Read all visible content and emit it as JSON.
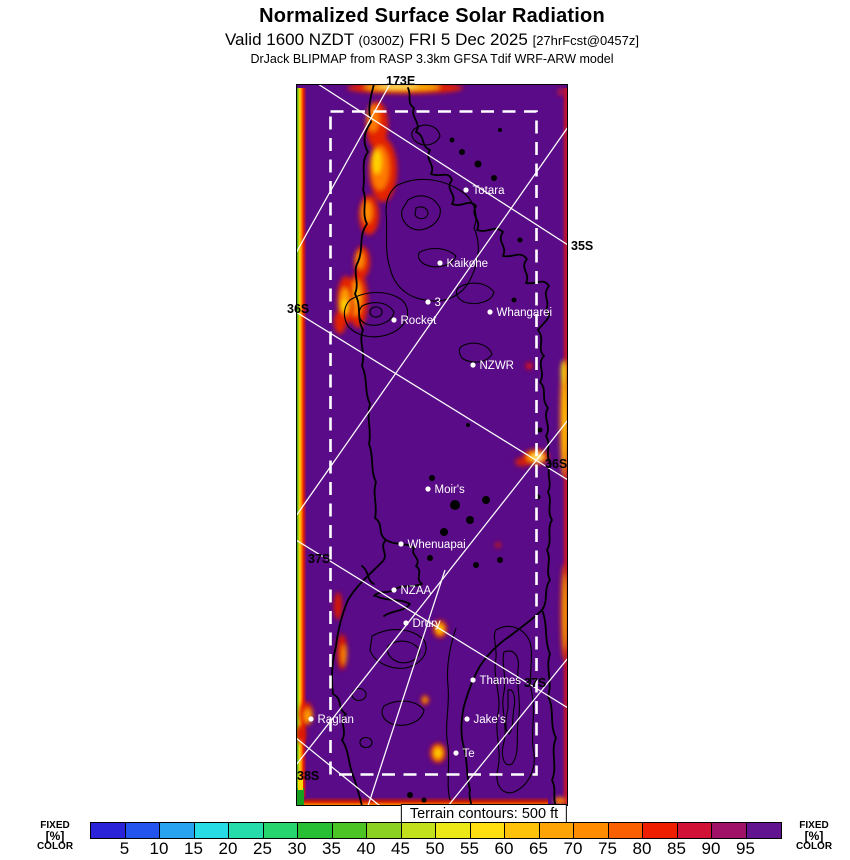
{
  "header": {
    "title": "Normalized Surface Solar Radiation",
    "valid_main_1": "Valid 1600 NZDT ",
    "valid_small_1": "(0300Z)",
    "valid_main_2": " FRI 5 Dec 2025 ",
    "valid_small_2": "[27hrFcst@0457z]",
    "model_line": "DrJack BLIPMAP from RASP 3.3km GFSA Tdif WRF-ARW model"
  },
  "map": {
    "terrain_note": "Terrain contours: 500 ft",
    "background_color": "#5a0b87",
    "stations": [
      {
        "name": "Totara",
        "x": 466,
        "y": 190
      },
      {
        "name": "Kaikohe",
        "x": 440,
        "y": 263
      },
      {
        "name": "3",
        "x": 428,
        "y": 302
      },
      {
        "name": "Rocket",
        "x": 394,
        "y": 320
      },
      {
        "name": "Whangarei",
        "x": 490,
        "y": 312
      },
      {
        "name": "NZWR",
        "x": 473,
        "y": 365
      },
      {
        "name": "Moir's",
        "x": 428,
        "y": 489
      },
      {
        "name": "Whenuapai",
        "x": 401,
        "y": 544
      },
      {
        "name": "NZAA",
        "x": 394,
        "y": 590
      },
      {
        "name": "Drury",
        "x": 406,
        "y": 623
      },
      {
        "name": "Thames",
        "x": 473,
        "y": 680
      },
      {
        "name": "Jake's",
        "x": 467,
        "y": 719
      },
      {
        "name": "Te",
        "x": 456,
        "y": 753
      },
      {
        "name": "Raglan",
        "x": 311,
        "y": 719
      }
    ],
    "grid_labels": [
      {
        "text": "173E",
        "x": 386,
        "y": 85
      },
      {
        "text": "35S",
        "x": 571,
        "y": 250
      },
      {
        "text": "36S",
        "x": 287,
        "y": 313
      },
      {
        "text": "36S",
        "x": 545,
        "y": 468
      },
      {
        "text": "37S",
        "x": 308,
        "y": 563
      },
      {
        "text": "37S",
        "x": 524,
        "y": 687
      },
      {
        "text": "38S",
        "x": 297,
        "y": 780
      }
    ]
  },
  "colorbar": {
    "units_label_lines": [
      "FIXED",
      "[%]",
      "COLOR"
    ],
    "unit": "%",
    "ticks": [
      "5",
      "10",
      "15",
      "20",
      "25",
      "30",
      "35",
      "40",
      "45",
      "50",
      "55",
      "60",
      "65",
      "70",
      "75",
      "80",
      "85",
      "90",
      "95"
    ],
    "segment_colors": [
      "#2a23d8",
      "#2355ee",
      "#27a3f2",
      "#27dce4",
      "#26dcab",
      "#26d56d",
      "#28bf35",
      "#4cc524",
      "#8ad121",
      "#c3e01d",
      "#ece818",
      "#ffdf10",
      "#ffc20a",
      "#ffa405",
      "#ff8c00",
      "#fa6000",
      "#ee1f00",
      "#d11135",
      "#a01168",
      "#62138f"
    ]
  },
  "colors": {
    "hotspot_red": "#e32000",
    "hotspot_orange": "#ff8c00",
    "hotspot_yellow": "#ffd400",
    "edge_crimson": "#b5123c",
    "graticule_white": "#ffffff"
  }
}
